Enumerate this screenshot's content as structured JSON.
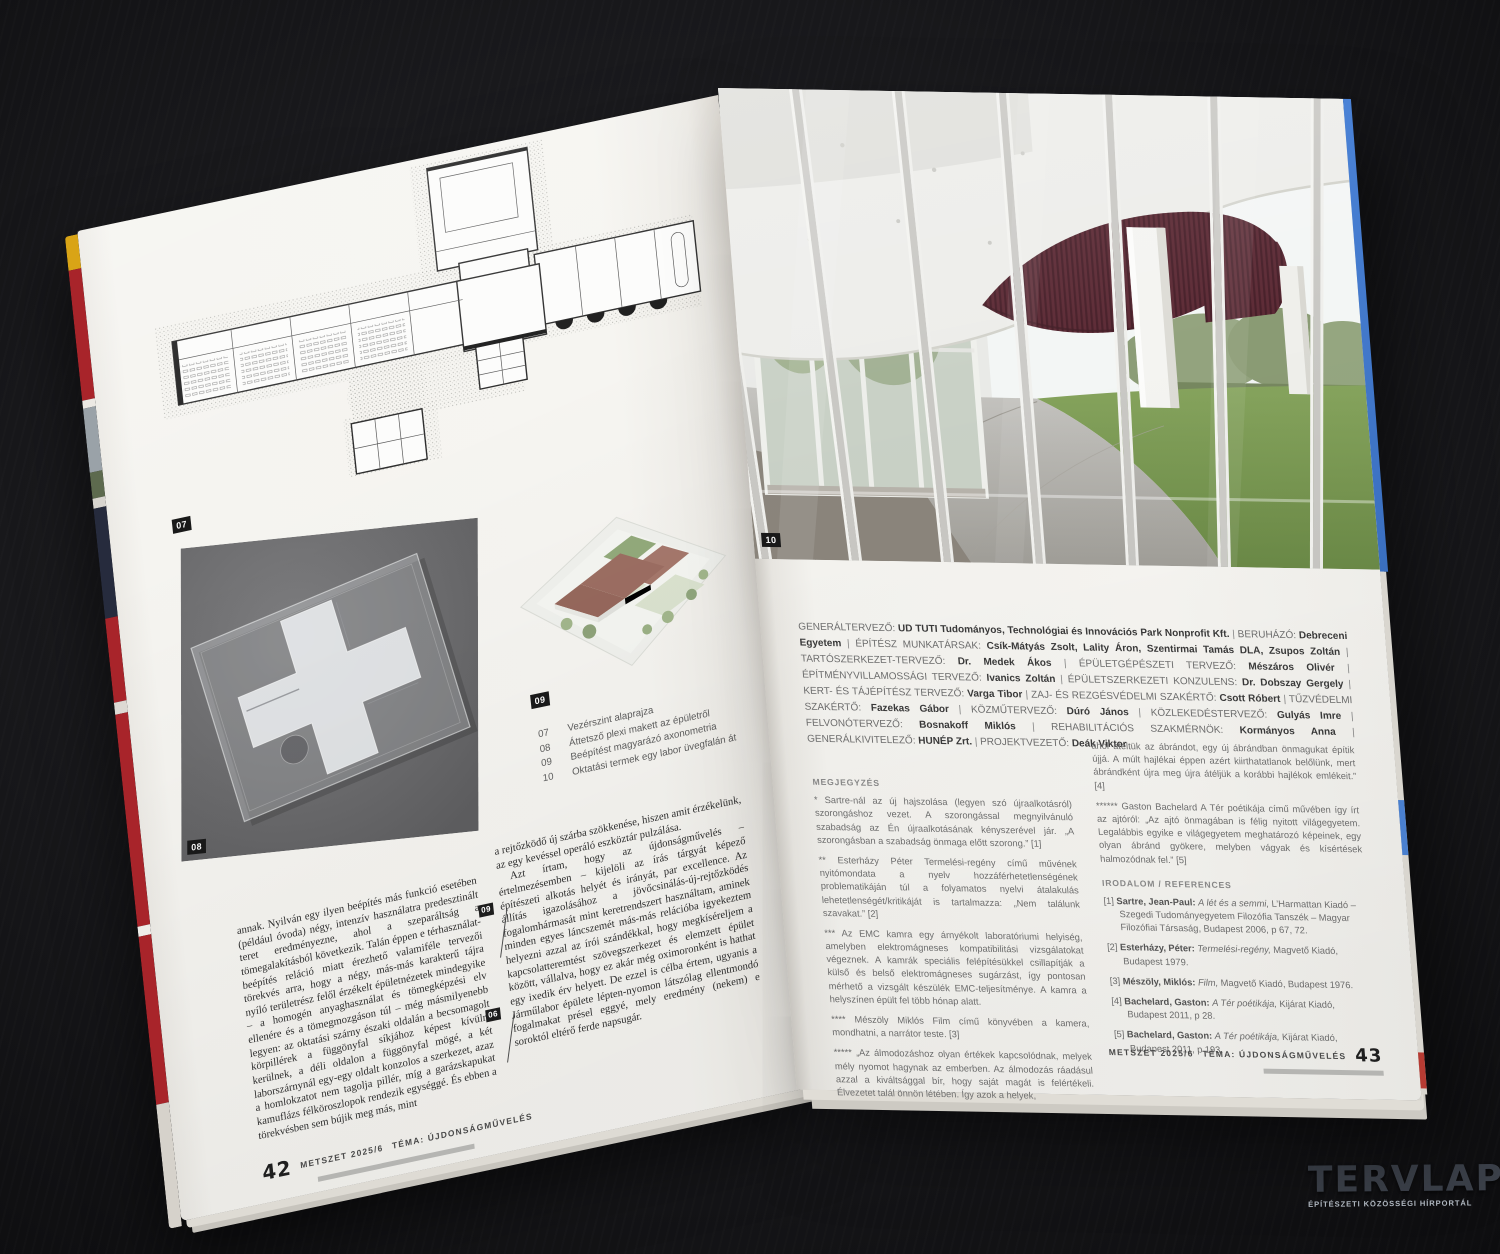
{
  "colors": {
    "paper": "#f5f4f0",
    "desk": "#17171a",
    "facade_maroon": "#5c2a35",
    "lawn_green": "#7d9b55",
    "page_edge_blue": "#4a82d6",
    "fore_edge_red": "#a8242a",
    "fore_edge_yellow": "#d9a416",
    "footer_bar_gray": "#bdbdba"
  },
  "desk_watermark": {
    "title": "TERVLAP",
    "tagline": "ÉPÍTÉSZETI KÖZÖSSÉGI HÍRPORTÁL"
  },
  "left_page": {
    "figures": {
      "plan_label": "07",
      "model_label": "08",
      "axon_label": "09"
    },
    "captions": [
      {
        "num": "07",
        "text": "Vezérszint alaprajza"
      },
      {
        "num": "08",
        "text": "Áttetsző plexi makett az épületről"
      },
      {
        "num": "09",
        "text": "Beépítést magyarázó axonometria"
      },
      {
        "num": "10",
        "text": "Oktatási termek egy labor üvegfalán át"
      }
    ],
    "margin_markers": {
      "top": "09",
      "bottom": "06"
    },
    "body": {
      "col1": "annak. Nyilván egy ilyen beépítés más funkció esetében (például óvoda) négy, intenzív használatra predesztinált teret eredményezne, ahol a szeparáltság a tömegalakításból következik. Talán éppen e térhasználat-beépítés reláció miatt érezhető valamiféle tervezői törekvés arra, hogy a négy, más-más karakterű tájra nyíló területrész felől érzékelt épületnézetek mindegyike – a homogén anyaghasználat és tömegképzési elv ellenére és a tömegmozgáson túl – még másmilyenebb legyen: az oktatási szárny északi oldalán a becsomagolt körpillérek a függönyfal síkjához képest kívülre kerülnek, a déli oldalon a függönyfal mögé, a két laborszárnynál egy-egy oldalt konzolos a szerkezet, azaz a homlokzatot nem tagolja pillér, míg a garázskapukat kamuflázs félköroszlopok rendezik egységgé. És ebben a törekvésben sem bújik meg más, mint",
      "col2_p1": "a rejtőzködő új szárba szökkenése, hiszen amit érzékelünk, az egy kevéssel operáló eszköztár pulzálása.",
      "col2_p2": "Azt írtam, hogy az újdonságművelés – értelmezésemben – kijelöli az írás tárgyát képező építészeti alkotás helyét és irányát, par excellence. Az állítás igazolásához a jövőcsinálás-új-rejtőzködés fogalomhármasát mint keretrendszert használtam, aminek minden egyes láncszemét más-más relációba igyekeztem helyezni azzal az írói szándékkal, hogy megkíséreljem a kapcsolatteremtést szövegszerkezet és elemzett épület között, vállalva, hogy ez akár még oximoronként is hathat egy ixedik érv helyett. De ezzel is célba értem, ugyanis a Járműlabor épülete lépten-nyomon látszólag ellentmondó fogalmakat présel eggyé, mely eredmény (nekem) e soroktól eltérő ferde napsugár."
    },
    "footer": {
      "page_number": "42",
      "journal": "METSZET 2025/6",
      "theme": "TÉMA: ÚJDONSÁGMŰVELÉS"
    }
  },
  "right_page": {
    "photo_label": "10",
    "credits": [
      {
        "role": "GENERÁLTERVEZŐ:",
        "name": "UD TUTI Tudományos, Technológiai és Innovációs Park Nonprofit Kft."
      },
      {
        "role": "BERUHÁZÓ:",
        "name": "Debreceni Egyetem"
      },
      {
        "role": "ÉPÍTÉSZ MUNKATÁRSAK:",
        "name": "Csík-Mátyás Zsolt, Lality Áron, Szentirmai Tamás DLA, Zsupos Zoltán"
      },
      {
        "role": "TARTÓSZERKEZET-TERVEZŐ:",
        "name": "Dr. Medek Ákos"
      },
      {
        "role": "ÉPÜLETGÉPÉSZETI TERVEZŐ:",
        "name": "Mészáros Olivér"
      },
      {
        "role": "ÉPÍTMÉNYVILLAMOSSÁGI TERVEZŐ:",
        "name": "Ivanics Zoltán"
      },
      {
        "role": "ÉPÜLETSZERKEZETI KONZULENS:",
        "name": "Dr. Dobszay Gergely"
      },
      {
        "role": "KERT- ÉS TÁJÉPÍTÉSZ TERVEZŐ:",
        "name": "Varga Tibor"
      },
      {
        "role": "ZAJ- ÉS REZGÉSVÉDELMI SZAKÉRTŐ:",
        "name": "Csott Róbert"
      },
      {
        "role": "TŰZVÉDELMI SZAKÉRTŐ:",
        "name": "Fazekas Gábor"
      },
      {
        "role": "KÖZMŰTERVEZŐ:",
        "name": "Dúró János"
      },
      {
        "role": "KÖZLEKEDÉSTERVEZŐ:",
        "name": "Gulyás Imre"
      },
      {
        "role": "FELVONÓTERVEZŐ:",
        "name": "Bosnakoff Miklós"
      },
      {
        "role": "REHABILITÁCIÓS SZAKMÉRNÖK:",
        "name": "Kormányos Anna"
      },
      {
        "role": "GENERÁLKIVITELEZŐ:",
        "name": "HUNÉP Zrt."
      },
      {
        "role": "PROJEKTVEZETŐ:",
        "name": "Deák Viktor"
      }
    ],
    "notes": {
      "title": "MEGJEGYZÉS",
      "items": [
        "* Sartre-nál az új hajszolása (legyen szó újraalkotásról) szorongáshoz vezet. A szorongással megnyilvánuló szabadság az Én újraalkotásának kényszerével jár. „A szorongásban a szabadság önmaga előtt szorong.” [1]",
        "** Esterházy Péter Termelési-regény című művének nyitómondata a nyelv hozzáférhetetlenségének problematikáján túl a folyamatos nyelvi átalakulás lehetetlenségét/kritikáját is tartalmazza: „Nem találunk szavakat.” [2]",
        "*** Az EMC kamra egy árnyékolt laboratóriumi helyiség, amelyben elektromágneses kompatibilitási vizsgálatokat végeznek. A kamrák speciális felépítésükkel csillapítják a külső és belső elektromágneses sugárzást, így pontosan mérhető a vizsgált készülék EMC-teljesítménye. A kamra a helyszínen épült fel több hónap alatt.",
        "**** Mészöly Miklós Film című könyvében a kamera, mondhatni, a narrátor teste. [3]",
        "***** „Az álmodozáshoz olyan értékek kapcsolódnak, melyek mély nyomot hagynak az emberben. Az álmodozás ráadásul azzal a kiváltsággal bír, hogy saját magát is felértékeli. Élvezetet talál önnön létében. Így azok a helyek,"
      ]
    },
    "continuation": [
      "ahol átéltük az ábrándot, egy új ábrándban önmagukat építik újjá. A múlt hajlékai éppen azért kiirthatatlanok belőlünk, mert ábrándként újra meg újra átéljük a korábbi hajlékok emlékeit.” [4]",
      "****** Gaston Bachelard A Tér poétikája című művében így írt az ajtóról: „Az ajtó önmagában is félig nyitott világegyetem. Legalábbis egyike e világegyetem meghatározó képeinek, egy olyan ábránd gyökere, melyben vágyak és kísértések halmozódnak fel.” [5]"
    ],
    "references": {
      "title": "IRODALOM / REFERENCES",
      "items": [
        {
          "id": "[1]",
          "author": "Sartre, Jean-Paul:",
          "title": "A lét és a semmi,",
          "rest": "L’Harmattan Kiadó – Szegedi Tudományegyetem Filozófia Tanszék – Magyar Filozófiai Társaság, Budapest 2006, p 67, 72."
        },
        {
          "id": "[2]",
          "author": "Esterházy, Péter:",
          "title": "Termelési-regény,",
          "rest": "Magvető Kiadó, Budapest 1979."
        },
        {
          "id": "[3]",
          "author": "Mészöly, Miklós:",
          "title": "Film,",
          "rest": "Magvető Kiadó, Budapest 1976."
        },
        {
          "id": "[4]",
          "author": "Bachelard, Gaston:",
          "title": "A Tér poétikája,",
          "rest": "Kijárat Kiadó, Budapest 2011, p 28."
        },
        {
          "id": "[5]",
          "author": "Bachelard, Gaston:",
          "title": "A Tér poétikája,",
          "rest": "Kijárat Kiadó, Budapest 2011, p 193."
        }
      ]
    },
    "footer": {
      "journal": "METSZET 2025/6",
      "theme": "TÉMA: ÚJDONSÁGMŰVELÉS",
      "page_number": "43"
    }
  }
}
